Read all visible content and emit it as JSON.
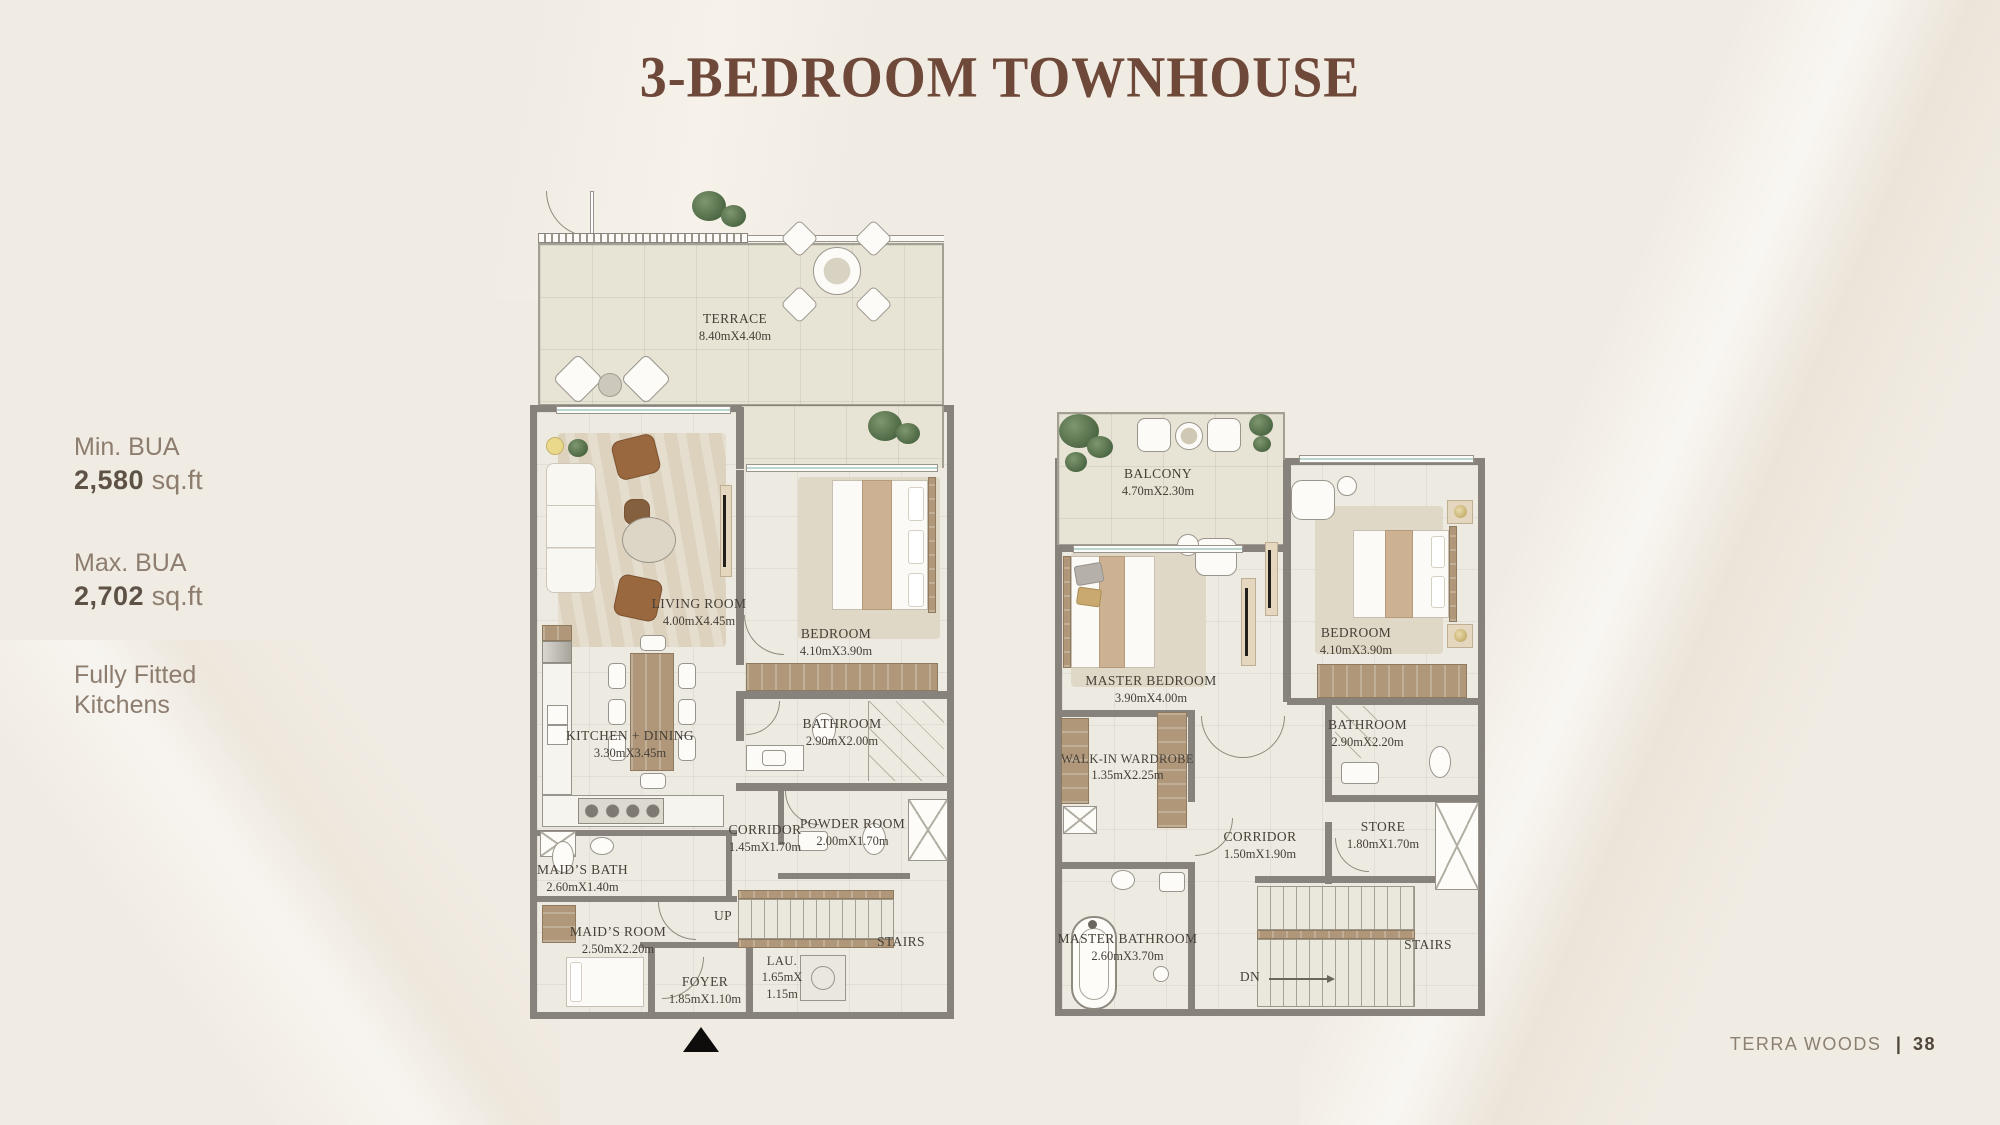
{
  "title": "3-BEDROOM TOWNHOUSE",
  "info": {
    "min_label": "Min. BUA",
    "min_value": "2,580",
    "min_unit": " sq.ft",
    "max_label": "Max. BUA",
    "max_value": "2,702",
    "max_unit": " sq.ft",
    "feature_line1": "Fully Fitted",
    "feature_line2": "Kitchens"
  },
  "footer": {
    "brand": "TERRA WOODS",
    "divider": "|",
    "page": "38"
  },
  "ground_floor": {
    "terrace": {
      "name": "TERRACE",
      "dims": "8.40mX4.40m"
    },
    "living": {
      "name": "LIVING ROOM",
      "dims": "4.00mX4.45m"
    },
    "bedroom": {
      "name": "BEDROOM",
      "dims": "4.10mX3.90m"
    },
    "bathroom": {
      "name": "BATHROOM",
      "dims": "2.90mX2.00m"
    },
    "kitchen": {
      "name": "KITCHEN + DINING",
      "dims": "3.30mX3.45m"
    },
    "corridor": {
      "name": "CORRIDOR",
      "dims": "1.45mX1.70m"
    },
    "powder": {
      "name": "POWDER ROOM",
      "dims": "2.00mX1.70m"
    },
    "maids_bath": {
      "name": "MAID’S BATH",
      "dims": "2.60mX1.40m"
    },
    "maids_room": {
      "name": "MAID’S ROOM",
      "dims": "2.50mX2.20m"
    },
    "foyer": {
      "name": "FOYER",
      "dims": "1.85mX1.10m"
    },
    "laundry": {
      "name": "LAU.",
      "dims1": "1.65mX",
      "dims2": "1.15m"
    },
    "up": "UP",
    "stairs": "STAIRS"
  },
  "first_floor": {
    "balcony": {
      "name": "BALCONY",
      "dims": "4.70mX2.30m"
    },
    "master_bedroom": {
      "name": "MASTER BEDROOM",
      "dims": "3.90mX4.00m"
    },
    "bedroom": {
      "name": "BEDROOM",
      "dims": "4.10mX3.90m"
    },
    "wardrobe": {
      "name": "WALK-IN WARDROBE",
      "dims": "1.35mX2.25m"
    },
    "corridor": {
      "name": "CORRIDOR",
      "dims": "1.50mX1.90m"
    },
    "bathroom": {
      "name": "BATHROOM",
      "dims": "2.90mX2.20m"
    },
    "store": {
      "name": "STORE",
      "dims": "1.80mX1.70m"
    },
    "master_bathroom": {
      "name": "MASTER BATHROOM",
      "dims": "2.60mX3.70m"
    },
    "dn": "DN",
    "stairs": "STAIRS"
  }
}
